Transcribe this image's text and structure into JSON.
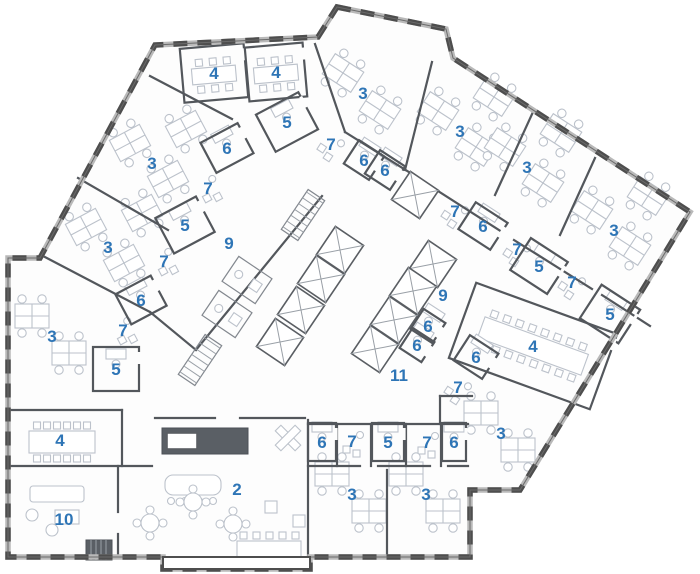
{
  "title": "office-floor-plan",
  "colors": {
    "label_blue": "#2e75b6",
    "wall_dark": "#4e4e4e",
    "wall_mid": "#53575c",
    "window_band": "#b9b9b9",
    "furniture_gray": "#bcc2cb",
    "background": "#ffffff"
  },
  "floorplan": {
    "outline": [
      [
        337,
        7
      ],
      [
        446,
        29
      ],
      [
        453,
        58
      ],
      [
        690,
        212
      ],
      [
        520,
        490
      ],
      [
        470,
        490
      ],
      [
        470,
        557
      ],
      [
        310,
        557
      ],
      [
        310,
        569
      ],
      [
        163,
        569
      ],
      [
        163,
        557
      ],
      [
        8,
        557
      ],
      [
        8,
        258
      ],
      [
        40,
        258
      ],
      [
        155,
        45
      ],
      [
        318,
        37
      ]
    ],
    "vestibule": [
      163,
      557,
      147,
      12
    ],
    "walls": [
      [
        150,
        76,
        232,
        119
      ],
      [
        315,
        44,
        345,
        132
      ],
      [
        78,
        178,
        168,
        230
      ],
      [
        43,
        256,
        150,
        312
      ],
      [
        150,
        312,
        196,
        350
      ],
      [
        196,
        350,
        322,
        196
      ],
      [
        345,
        132,
        412,
        174
      ],
      [
        424,
        182,
        502,
        232
      ],
      [
        514,
        240,
        592,
        289
      ],
      [
        602,
        295,
        650,
        326
      ],
      [
        432,
        62,
        405,
        170
      ],
      [
        533,
        112,
        495,
        195
      ],
      [
        595,
        158,
        560,
        235
      ],
      [
        8,
        410,
        122,
        410
      ],
      [
        122,
        410,
        122,
        466
      ],
      [
        8,
        466,
        152,
        466
      ],
      [
        118,
        466,
        118,
        512
      ],
      [
        118,
        534,
        118,
        557
      ],
      [
        155,
        418,
        215,
        418
      ],
      [
        240,
        418,
        305,
        418
      ],
      [
        308,
        420,
        308,
        557
      ],
      [
        308,
        424,
        468,
        424
      ],
      [
        337,
        424,
        337,
        466
      ],
      [
        371,
        424,
        371,
        466
      ],
      [
        406,
        424,
        406,
        466
      ],
      [
        441,
        424,
        441,
        466
      ],
      [
        308,
        466,
        360,
        466
      ],
      [
        378,
        466,
        430,
        466
      ],
      [
        448,
        466,
        468,
        466
      ],
      [
        387,
        470,
        387,
        557
      ],
      [
        440,
        396,
        472,
        396
      ],
      [
        440,
        396,
        440,
        424
      ]
    ],
    "elevator_shafts": {
      "rot": 34,
      "size": 34,
      "centers": [
        [
          340,
          250
        ],
        [
          321,
          279
        ],
        [
          301,
          310
        ],
        [
          280,
          342
        ],
        [
          433,
          264
        ],
        [
          413,
          291
        ],
        [
          394,
          320
        ],
        [
          375,
          349
        ],
        [
          415,
          195
        ]
      ]
    },
    "stairs": [
      {
        "x": 303,
        "y": 215,
        "r": 34
      },
      {
        "x": 200,
        "y": 360,
        "r": 34
      }
    ],
    "utility_boxes": [
      {
        "x": 247,
        "y": 280,
        "r": 34,
        "w": 40,
        "h": 30
      },
      {
        "x": 227,
        "y": 314,
        "r": 34,
        "w": 40,
        "h": 30
      }
    ],
    "rooms": [
      {
        "n": "4",
        "x": 214,
        "y": 73,
        "r": -5,
        "t": "confS",
        "box": [
          64,
          54
        ]
      },
      {
        "n": "4",
        "x": 276,
        "y": 72,
        "r": -5,
        "t": "confS",
        "box": [
          58,
          54
        ]
      },
      {
        "n": "5",
        "x": 287,
        "y": 122,
        "r": -28,
        "t": "small",
        "box": [
          48,
          42
        ]
      },
      {
        "n": "6",
        "x": 227,
        "y": 148,
        "r": -28,
        "t": "small",
        "box": [
          42,
          34
        ]
      },
      {
        "n": "7",
        "x": 208,
        "y": 188,
        "r": -28,
        "t": "tiny"
      },
      {
        "n": "3",
        "x": 152,
        "y": 163,
        "r": -28,
        "t": "office3"
      },
      {
        "n": "5",
        "x": 185,
        "y": 225,
        "r": -28,
        "t": "small",
        "box": [
          46,
          40
        ]
      },
      {
        "n": "9",
        "x": 229,
        "y": 243,
        "r": -28,
        "t": "corridor"
      },
      {
        "n": "3",
        "x": 108,
        "y": 247,
        "r": -28,
        "t": "office3"
      },
      {
        "n": "7",
        "x": 164,
        "y": 261,
        "r": -28,
        "t": "tiny"
      },
      {
        "n": "6",
        "x": 141,
        "y": 300,
        "r": -28,
        "t": "small",
        "box": [
          40,
          34
        ]
      },
      {
        "n": "7",
        "x": 123,
        "y": 330,
        "r": -28,
        "t": "tiny"
      },
      {
        "n": "3",
        "x": 52,
        "y": 336,
        "r": 0,
        "t": "office2"
      },
      {
        "n": "5",
        "x": 116,
        "y": 369,
        "r": 0,
        "t": "small",
        "box": [
          46,
          44
        ]
      },
      {
        "n": "3",
        "x": 363,
        "y": 93,
        "r": 33,
        "t": "office2"
      },
      {
        "n": "7",
        "x": 331,
        "y": 144,
        "r": 33,
        "t": "tiny"
      },
      {
        "n": "6",
        "x": 364,
        "y": 160,
        "r": 33,
        "t": "small",
        "box": [
          30,
          28
        ]
      },
      {
        "n": "6",
        "x": 385,
        "y": 170,
        "r": 33,
        "t": "small",
        "box": [
          30,
          28
        ]
      },
      {
        "n": "3",
        "x": 460,
        "y": 131,
        "r": 33,
        "t": "office3"
      },
      {
        "n": "3",
        "x": 527,
        "y": 167,
        "r": 33,
        "t": "office3"
      },
      {
        "n": "7",
        "x": 455,
        "y": 211,
        "r": 33,
        "t": "tiny"
      },
      {
        "n": "6",
        "x": 483,
        "y": 226,
        "r": 33,
        "t": "small",
        "box": [
          38,
          32
        ]
      },
      {
        "n": "3",
        "x": 614,
        "y": 230,
        "r": 33,
        "t": "office3"
      },
      {
        "n": "7",
        "x": 517,
        "y": 249,
        "r": 33,
        "t": "tiny"
      },
      {
        "n": "5",
        "x": 539,
        "y": 266,
        "r": 33,
        "t": "small",
        "box": [
          44,
          38
        ]
      },
      {
        "n": "7",
        "x": 572,
        "y": 282,
        "r": 33,
        "t": "tiny"
      },
      {
        "n": "9",
        "x": 443,
        "y": 295,
        "r": 33,
        "t": "corridor"
      },
      {
        "n": "5",
        "x": 610,
        "y": 314,
        "r": 33,
        "t": "small",
        "box": [
          46,
          40
        ]
      },
      {
        "n": "6",
        "x": 428,
        "y": 326,
        "r": 33,
        "t": "small",
        "box": [
          26,
          24
        ]
      },
      {
        "n": "6",
        "x": 417,
        "y": 345,
        "r": 33,
        "t": "small",
        "box": [
          26,
          24
        ]
      },
      {
        "n": "4",
        "x": 533,
        "y": 346,
        "r": 20,
        "t": "confL",
        "box": [
          150,
          80
        ]
      },
      {
        "n": "6",
        "x": 476,
        "y": 357,
        "r": 33,
        "t": "small",
        "box": [
          34,
          30
        ]
      },
      {
        "n": "11",
        "x": 399,
        "y": 375,
        "r": 0,
        "t": "corridor"
      },
      {
        "n": "7",
        "x": 458,
        "y": 387,
        "r": 33,
        "t": "tiny"
      },
      {
        "n": "4",
        "x": 60,
        "y": 440,
        "r": 0,
        "t": "confM"
      },
      {
        "n": "10",
        "x": 64,
        "y": 519,
        "r": 0,
        "t": "lounge10"
      },
      {
        "n": "2",
        "x": 237,
        "y": 489,
        "r": 0,
        "t": "lounge2"
      },
      {
        "n": "6",
        "x": 322,
        "y": 442,
        "r": 0,
        "t": "small",
        "box": [
          28,
          38
        ]
      },
      {
        "n": "7",
        "x": 352,
        "y": 441,
        "r": 0,
        "t": "tiny"
      },
      {
        "n": "5",
        "x": 388,
        "y": 442,
        "r": 0,
        "t": "small",
        "box": [
          32,
          38
        ]
      },
      {
        "n": "7",
        "x": 427,
        "y": 442,
        "r": 0,
        "t": "tiny"
      },
      {
        "n": "6",
        "x": 454,
        "y": 442,
        "r": 0,
        "t": "small",
        "box": [
          24,
          38
        ]
      },
      {
        "n": "3",
        "x": 352,
        "y": 494,
        "r": 0,
        "t": "office2"
      },
      {
        "n": "3",
        "x": 426,
        "y": 494,
        "r": 0,
        "t": "office2"
      },
      {
        "n": "3",
        "x": 501,
        "y": 433,
        "r": 0,
        "t": "office2"
      }
    ]
  }
}
